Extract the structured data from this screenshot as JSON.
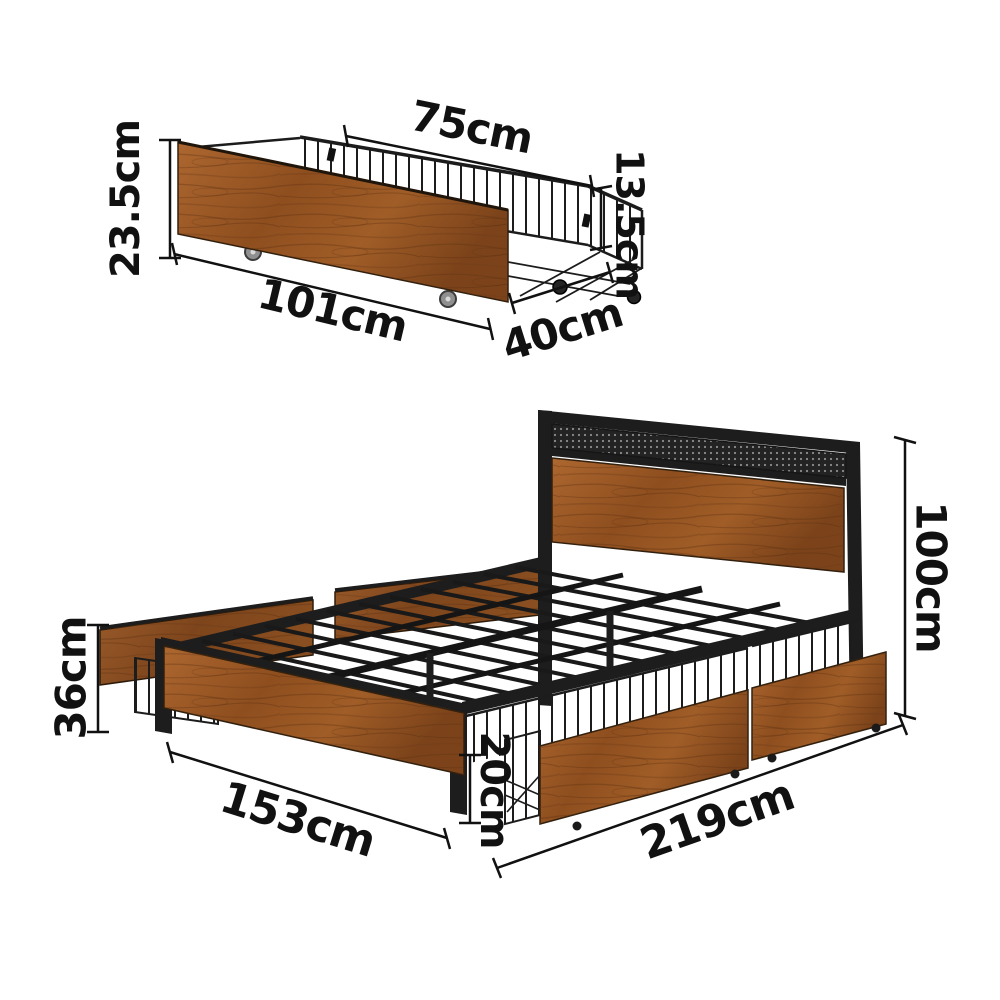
{
  "title": "Bed frame with under-bed storage drawers - dimension diagram",
  "colors": {
    "metal": "#1d1d1d",
    "wood": "#9c5a28",
    "wood_dark": "#7a431a",
    "wheel_gray": "#8f8f8f",
    "dimension": "#111111"
  },
  "drawer": {
    "name": "under-bed storage drawer",
    "dimensions": {
      "top_width": "75cm",
      "front_height": "23.5cm",
      "basket_height": "13.5cm",
      "length": "101cm",
      "depth": "40cm"
    }
  },
  "bed": {
    "name": "bed frame with storage drawers",
    "dimensions": {
      "headboard_height": "100cm",
      "side_panel_height": "36cm",
      "width": "153cm",
      "drawer_height": "20cm",
      "length": "219cm"
    }
  }
}
